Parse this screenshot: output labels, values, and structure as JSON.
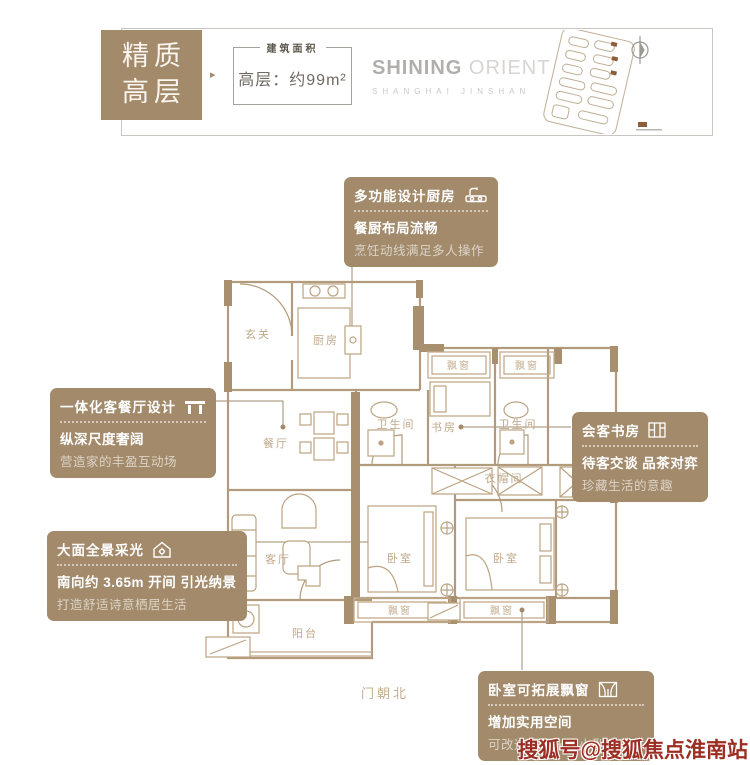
{
  "header": {
    "badge": {
      "line1": "精质",
      "line2": "高层"
    },
    "arrow": "▸",
    "area_box": {
      "label": "建筑面积",
      "value": "高层：约99m²"
    },
    "logo": {
      "primary": "SHINING",
      "secondary": "ORIENT",
      "subtitle": "SHANGHAI JINSHAN"
    }
  },
  "callouts": [
    {
      "title": "多功能设计厨房",
      "icon": "kitchen-sink-icon",
      "line1": "餐厨布局流畅",
      "line2": "烹饪动线满足多人操作"
    },
    {
      "title": "一体化客餐厅设计",
      "icon": "table-icon",
      "line1": "纵深尺度奢阔",
      "line2": "营造家的丰盈互动场"
    },
    {
      "title": "会客书房",
      "icon": "bookshelf-icon",
      "line1": "待客交谈 品茶对弈",
      "line2": "珍藏生活的意趣"
    },
    {
      "title": "大面全景采光",
      "icon": "house-sun-icon",
      "line1": "南向约 3.65m 开间 引光纳景",
      "line2": "打造舒适诗意栖居生活"
    },
    {
      "title": "卧室可拓展飘窗",
      "icon": "bay-window-icon",
      "line1": "增加实用空间",
      "line2": "可改造榻榻米或小型阅读角"
    }
  ],
  "floorplan": {
    "rooms": {
      "entry": "玄关",
      "kitchen": "厨房",
      "dining": "餐厅",
      "living": "客厅",
      "balcony": "阳台",
      "bath": "卫生间",
      "study": "书房",
      "cloak": "衣帽间",
      "bedroom": "卧室",
      "bay": "飘窗",
      "north_note": "门朝北"
    }
  },
  "watermark": {
    "text": "搜狐号@搜狐焦点淮南站"
  },
  "colors": {
    "gold": "#a28a6b",
    "plan_line": "#b29a7c",
    "wall_fill": "#a8906f",
    "label_text": "#bfa98b",
    "watermark_red": "#9c2d22"
  }
}
